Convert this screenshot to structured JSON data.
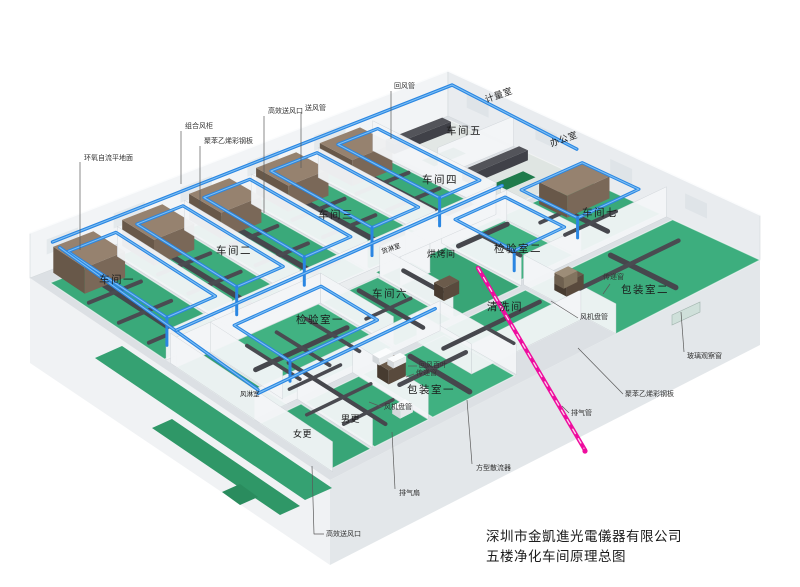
{
  "diagram": {
    "company": "深圳市金凱進光電儀器有限公司",
    "title": "五楼净化车间原理总图"
  },
  "rooms": [
    {
      "id": "workshop-1",
      "label": "车间一"
    },
    {
      "id": "workshop-2",
      "label": "车间二"
    },
    {
      "id": "workshop-3",
      "label": "车间三"
    },
    {
      "id": "workshop-4",
      "label": "车间四"
    },
    {
      "id": "workshop-5",
      "label": "车间五"
    },
    {
      "id": "workshop-6",
      "label": "车间六"
    },
    {
      "id": "workshop-7",
      "label": "车间七"
    },
    {
      "id": "metrology-room",
      "label": "计量室"
    },
    {
      "id": "office",
      "label": "办公室"
    },
    {
      "id": "cargo-shower",
      "label": "货淋室"
    },
    {
      "id": "baking-room",
      "label": "烘烤间"
    },
    {
      "id": "inspection-room-2",
      "label": "检验室二"
    },
    {
      "id": "cleaning-room",
      "label": "清洗间"
    },
    {
      "id": "inspection-room-1",
      "label": "检验室一"
    },
    {
      "id": "packing-room-2",
      "label": "包装室二"
    },
    {
      "id": "packing-room-1",
      "label": "包装室一"
    },
    {
      "id": "air-shower",
      "label": "风淋室"
    },
    {
      "id": "women-changing",
      "label": "女更"
    },
    {
      "id": "men-changing",
      "label": "男更"
    }
  ],
  "callouts": [
    {
      "id": "epoxy-floor",
      "label": "环氧自流平地面"
    },
    {
      "id": "combined-ahu",
      "label": "组合风柜"
    },
    {
      "id": "steel-panel-top",
      "label": "聚苯乙烯彩钢板"
    },
    {
      "id": "hepa-outlet-top",
      "label": "高效送风口"
    },
    {
      "id": "supply-duct",
      "label": "送风管"
    },
    {
      "id": "return-duct",
      "label": "回风管"
    },
    {
      "id": "pass-window-right",
      "label": "传递窗"
    },
    {
      "id": "glass-window",
      "label": "玻璃观察窗"
    },
    {
      "id": "steel-panel-right",
      "label": "聚苯乙烯彩钢板"
    },
    {
      "id": "exhaust-pipe",
      "label": "排气管"
    },
    {
      "id": "square-diffuser",
      "label": "方型散流器"
    },
    {
      "id": "exhaust-fan",
      "label": "排气扇"
    },
    {
      "id": "hepa-outlet-bottom",
      "label": "高效送风口"
    },
    {
      "id": "fan-coil-right",
      "label": "风机盘管"
    },
    {
      "id": "fan-coil-bottom",
      "label": "风机盘管"
    },
    {
      "id": "return-louver",
      "label": "回风百叶"
    },
    {
      "id": "pass-window-bottom",
      "label": "传递窗"
    }
  ],
  "colors": {
    "pipe_blue": "#2a86e2",
    "pipe_highlight": "#7fc0f4",
    "floor_green": "#3aa97a",
    "duct_gray": "#46474d",
    "ahu_brown": "#96826f",
    "exhaust_magenta": "#ee0d9e",
    "wall_white": "#f4f6f8"
  }
}
